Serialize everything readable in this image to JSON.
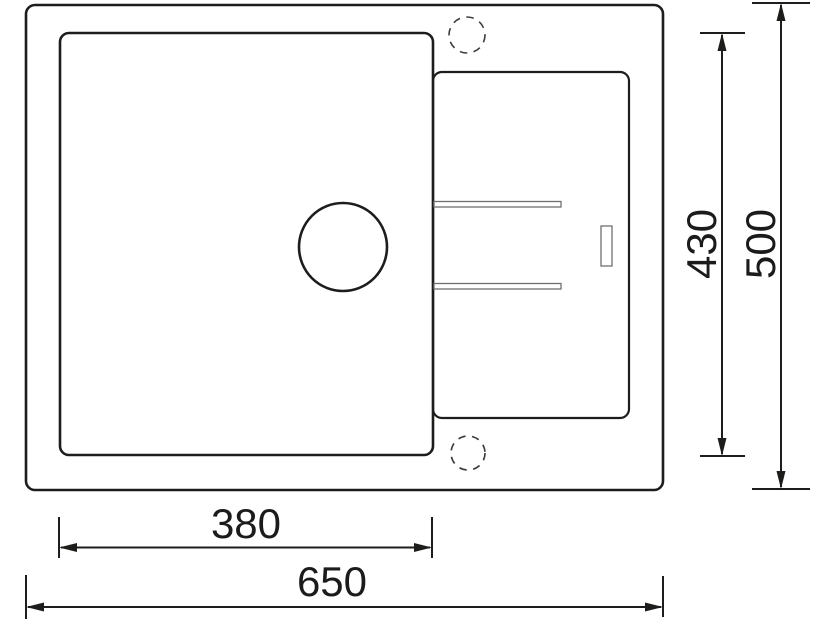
{
  "drawing": {
    "kind": "sink-technical-drawing-top-view",
    "background_color": "#ffffff",
    "line_color": "#1d1d1b",
    "thin_line_color": "#6f6f6f",
    "dims": {
      "bowl_width": "380",
      "overall_width": "650",
      "inner_length": "430",
      "overall_length": "500"
    },
    "features": [
      "sink-outline",
      "bowl-outline",
      "drainer-outline",
      "drain-hole",
      "tap-hole-top",
      "tap-hole-bottom",
      "drainer-groove-upper",
      "drainer-groove-lower",
      "overflow-slot"
    ]
  }
}
